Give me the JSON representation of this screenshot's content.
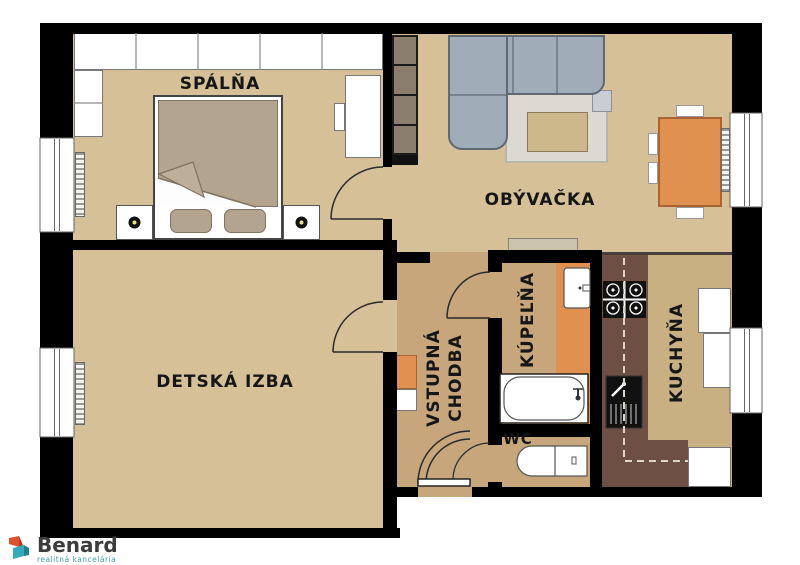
{
  "plan": {
    "rooms": {
      "bedroom": {
        "label": "SPÁLŇA"
      },
      "living_room": {
        "label": "OBÝVAČKA"
      },
      "kids_room": {
        "label": "DETSKÁ IZBA"
      },
      "entrance_hall": {
        "label_line1": "VSTUPNÁ",
        "label_line2": "CHODBA"
      },
      "bathroom": {
        "label": "KÚPEĽŇA"
      },
      "wc": {
        "label": "WC"
      },
      "kitchen": {
        "label": "KUCHYŇA"
      }
    },
    "colors": {
      "wall": "#000000",
      "room_floor": "#d5c098",
      "hall_floor": "#c6a67a",
      "kitchen_floor": "#c8b083",
      "tile_orange": "#e0914f",
      "counter_brown": "#6e4f44",
      "sofa_gray": "#a0adb8"
    }
  },
  "branding": {
    "company": "Benard",
    "tagline": "realitná kancelária",
    "logo_orange": "#e2512e",
    "logo_teal": "#35aabc"
  }
}
